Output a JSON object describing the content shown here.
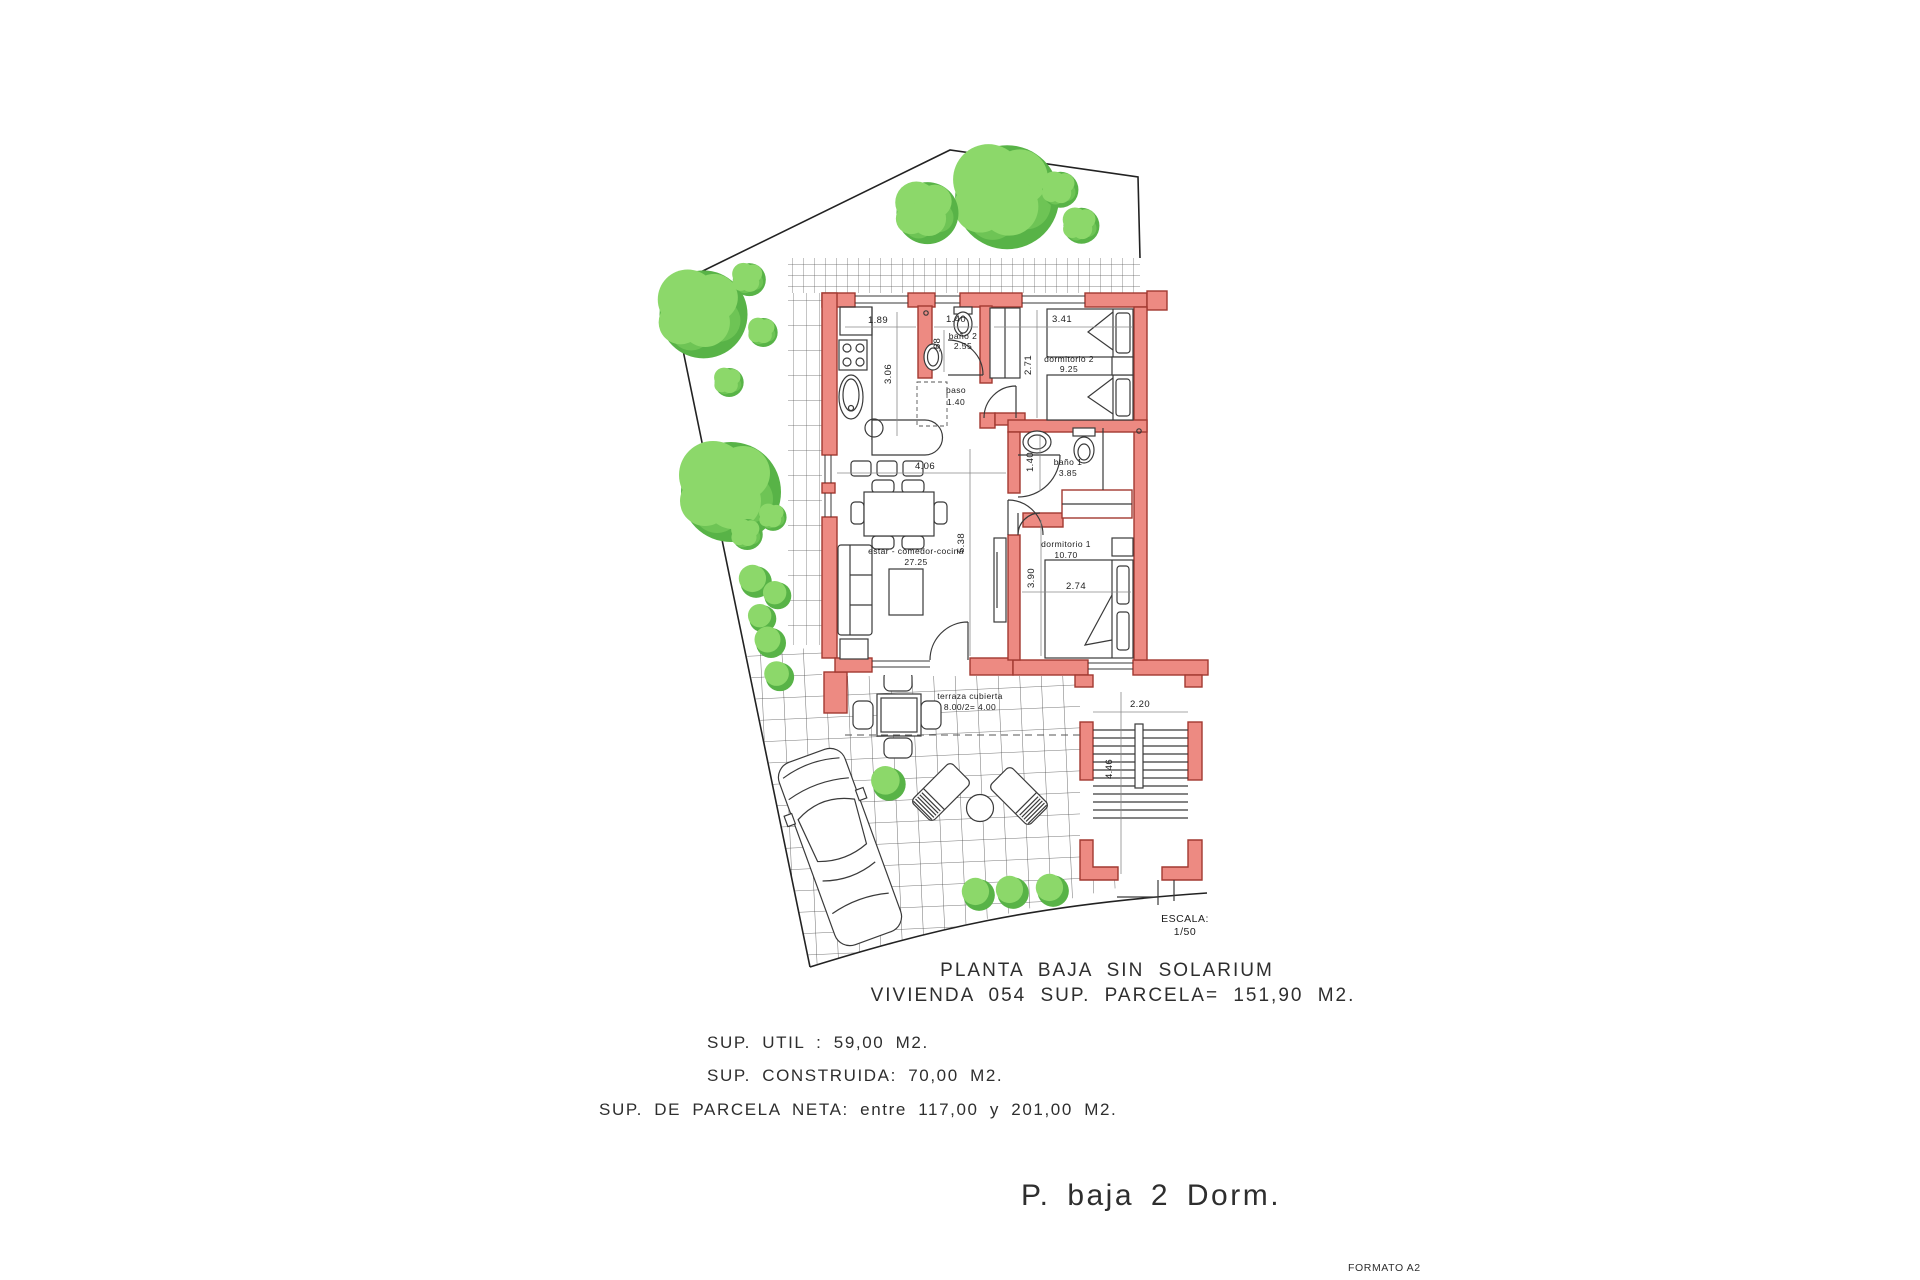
{
  "plan": {
    "title": "PLANTA BAJA SIN SOLARIUM",
    "subtitle": "VIVIENDA 054 SUP. PARCELA= 151,90 M2.",
    "sup_util": "SUP. UTIL : 59,00 M2.",
    "sup_construida": "SUP. CONSTRUIDA: 70,00 M2.",
    "sup_parcela": "SUP. DE PARCELA NETA: entre 117,00 y 201,00 M2.",
    "footer": "P. baja 2 Dorm.",
    "format": "FORMATO A2",
    "scale_label": "ESCALA:",
    "scale_value": "1/50"
  },
  "rooms": {
    "bano2": {
      "name": "baño 2",
      "area": "2.55"
    },
    "paso": {
      "name": "paso",
      "area": "1.40"
    },
    "dorm2": {
      "name": "dormitorio 2",
      "area": "9.25"
    },
    "bano1": {
      "name": "baño 1",
      "area": "3.85"
    },
    "dorm1": {
      "name": "dormitorio 1",
      "area": "10.70"
    },
    "estar": {
      "name": "estar - comedor-cocina",
      "area": "27.25"
    },
    "terraza": {
      "name": "terraza cubierta",
      "area": "8.00/2= 4.00"
    }
  },
  "dims": {
    "kitchen_w": "1.89",
    "kitchen_h": "3.06",
    "bano2_w": "1.40",
    "bano2_d": ".68",
    "dorm2_w": "3.41",
    "dorm2_h": "2.71",
    "estar_w": "4.06",
    "estar_h": "5.38",
    "bano1_h": "1.40",
    "dorm1_h": "3.90",
    "dorm1_w": "2.74",
    "stairs_w": "2.20",
    "stairs_h": "4.46"
  },
  "colors": {
    "wall_fill": "#ED8A82",
    "wall_stroke": "#A23931",
    "tree_light": "#8CD86A",
    "tree_mid": "#6EC455",
    "tree_dark": "#58B347"
  }
}
